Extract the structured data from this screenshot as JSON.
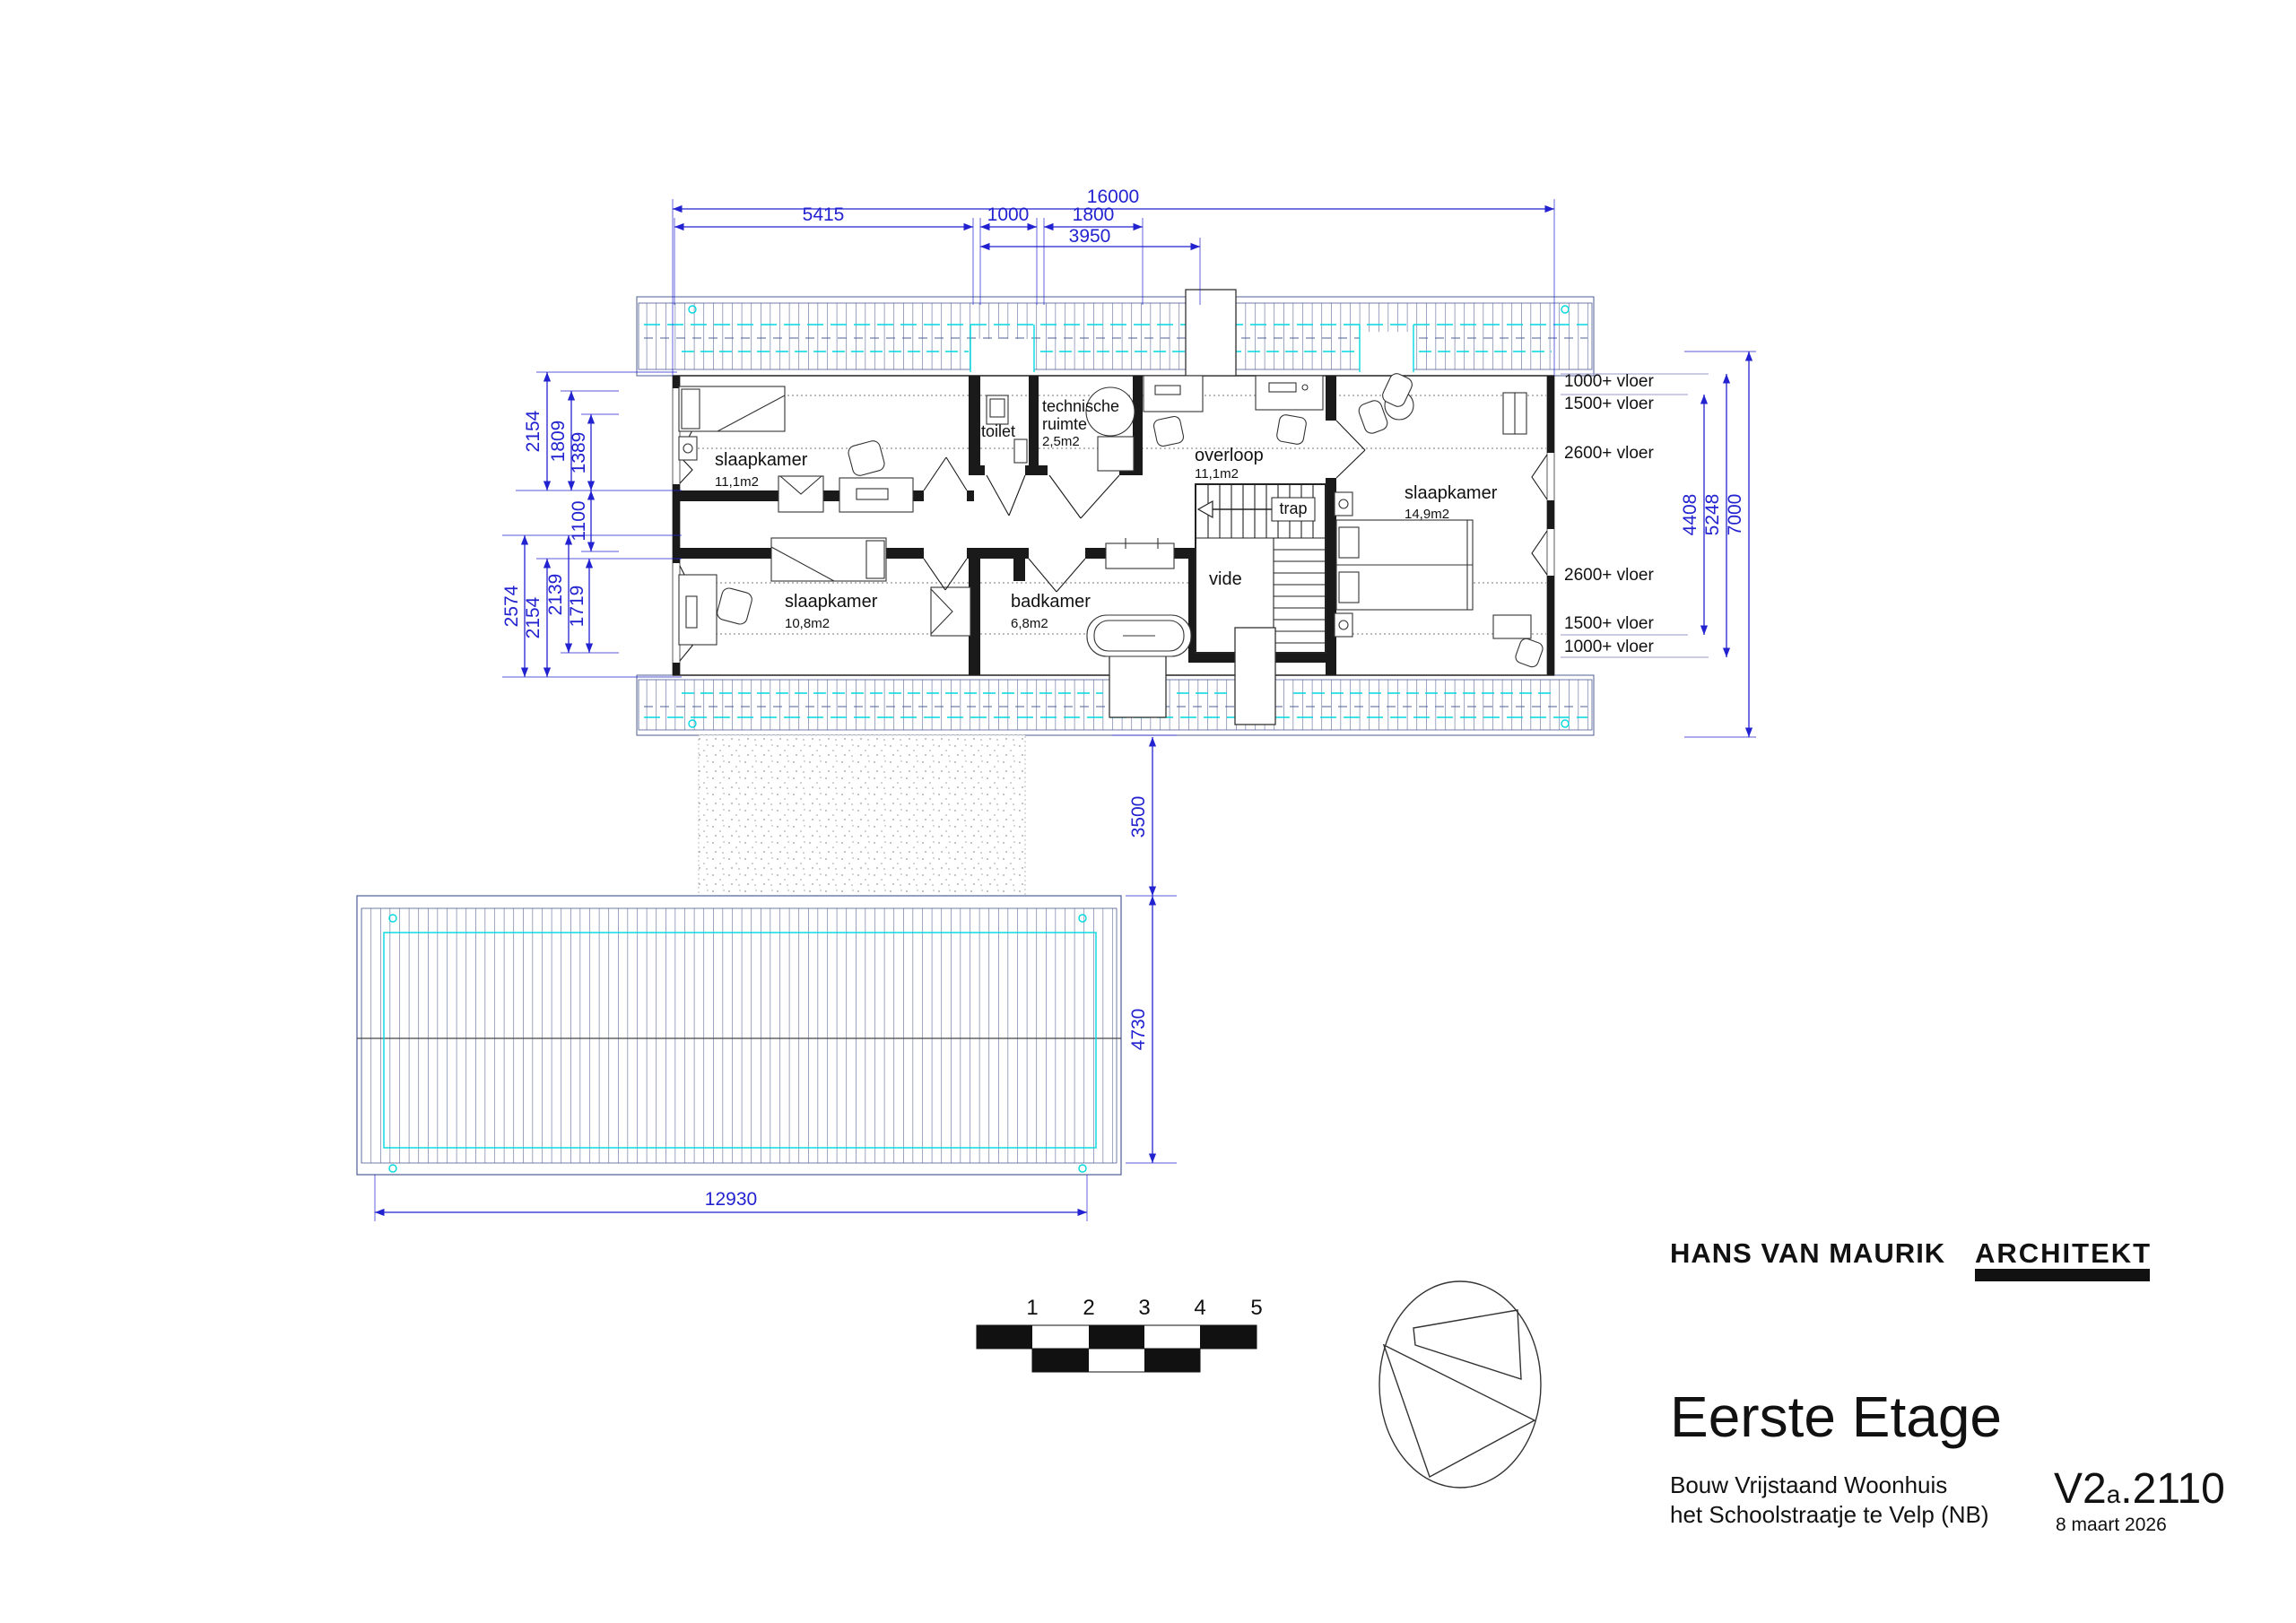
{
  "rooms": {
    "slaapkamer_nw": {
      "name": "slaapkamer",
      "area": "11,1m2"
    },
    "slaapkamer_sw": {
      "name": "slaapkamer",
      "area": "10,8m2"
    },
    "slaapkamer_e": {
      "name": "slaapkamer",
      "area": "14,9m2"
    },
    "toilet": {
      "name": "toilet"
    },
    "tech": {
      "name1": "technische",
      "name2": "ruimte",
      "area": "2,5m2"
    },
    "overloop": {
      "name": "overloop",
      "area": "11,1m2"
    },
    "badkamer": {
      "name": "badkamer",
      "area": "6,8m2"
    },
    "trap": {
      "name": "trap"
    },
    "vide": {
      "name": "vide"
    }
  },
  "dims": {
    "top_total": "16000",
    "top_1": "5415",
    "top_2": "1000",
    "top_3": "1800",
    "top_4": "3950",
    "left_1": "2154",
    "left_2": "1809",
    "left_3": "1389",
    "left_4": "1100",
    "left_5": "2574",
    "left_6": "2154",
    "left_7": "2139",
    "left_8": "1719",
    "right_1": "4408",
    "right_2": "5248",
    "right_3": "7000",
    "south_gap": "3500",
    "roof_depth": "4730",
    "roof_width": "12930"
  },
  "levels": {
    "t1": "1000+ vloer",
    "t2": "1500+ vloer",
    "t3": "2600+ vloer",
    "b1": "2600+ vloer",
    "b2": "1500+ vloer",
    "b3": "1000+ vloer"
  },
  "scalebar": [
    "1",
    "2",
    "3",
    "4",
    "5"
  ],
  "titleblock": {
    "firm": "HANS VAN MAURIK",
    "firm2": "ARCHITEKT",
    "title": "Eerste Etage",
    "project1": "Bouw Vrijstaand Woonhuis",
    "project2": "het Schoolstraatje te Velp (NB)",
    "code_main": "V2",
    "code_sub": "a",
    "code_rest": ".2110",
    "date": "8 maart 2026"
  },
  "colors": {
    "dimension_blue": "#2222d0",
    "roof_hatch_navy": "#4d5d92",
    "accent_cyan": "#00d8e0",
    "plan_black": "#1a1a1a"
  }
}
